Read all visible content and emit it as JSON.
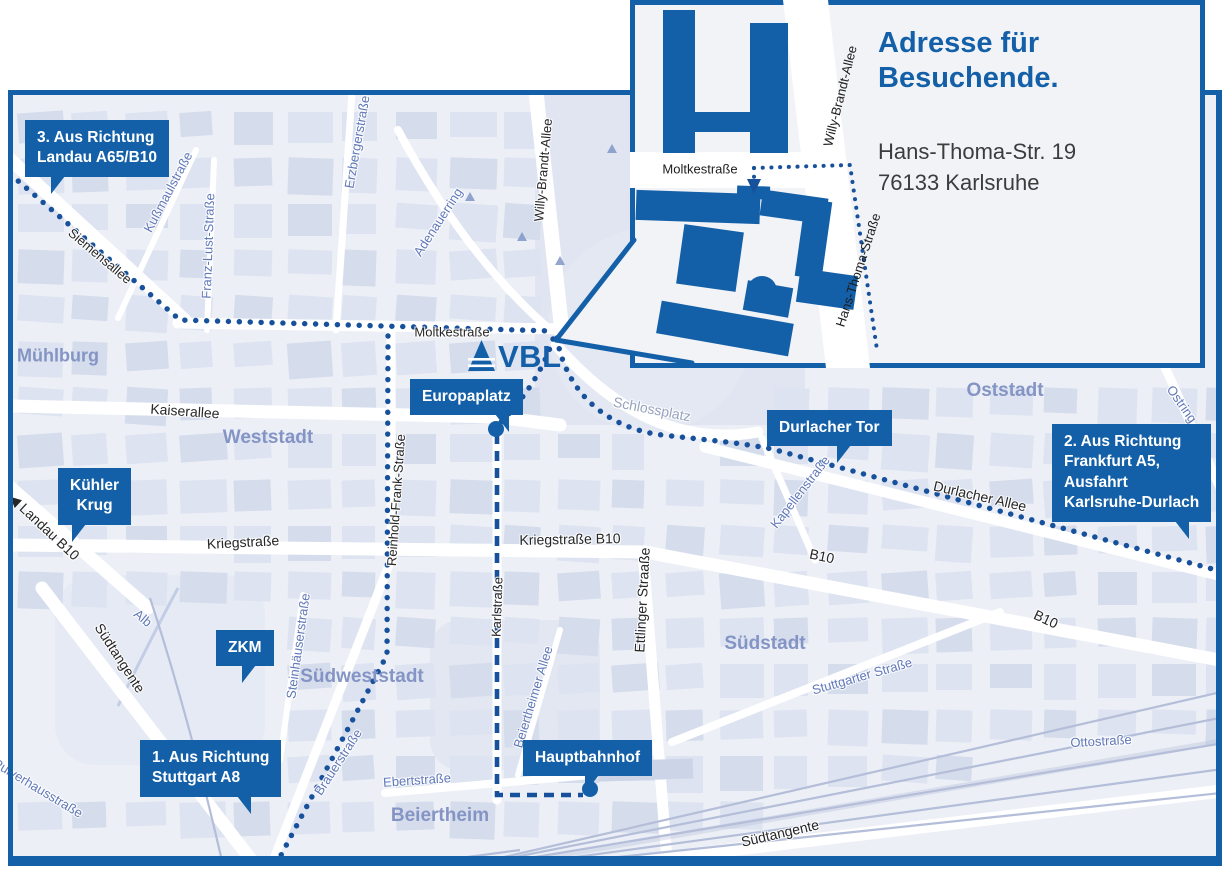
{
  "colors": {
    "brand_blue": "#1460a8",
    "route_blue": "#17519c",
    "map_bg": "#eceff6",
    "block": "#dde3f0",
    "block_dark": "#d5dcec",
    "road": "#ffffff",
    "railway": "#b4bed9",
    "district_label": "#8494c4",
    "street_blue": "#6078b8",
    "street_gray": "#97a2bd",
    "street_black": "#262626",
    "inset_bg": "#f2f3f7",
    "text_dark": "#3c3c3c"
  },
  "logo": {
    "text": "VBL"
  },
  "inset": {
    "title": [
      "Adresse für",
      "Besuchende."
    ],
    "address": [
      "Hans-Thoma-Str. 19",
      "76133 Karlsruhe"
    ],
    "street_labels": [
      {
        "t": "Moltkestraße",
        "x": 70,
        "y": 169,
        "r": 0
      },
      {
        "t": "Willy-Brandt-Allee",
        "x": 210,
        "y": 96,
        "r": -76
      },
      {
        "t": "Hans-Thoma-Straße",
        "x": 228,
        "y": 270,
        "r": -72
      }
    ]
  },
  "map": {
    "callouts": [
      {
        "id": "route-3",
        "lines": [
          "3. Aus Richtung",
          "Landau A65/B10"
        ],
        "x": 25,
        "y": 120,
        "tail": {
          "dir": "dl",
          "side": "left",
          "off": 26
        }
      },
      {
        "id": "kuehler-krug",
        "lines": [
          "Kühler",
          "Krug"
        ],
        "x": 58,
        "y": 468,
        "center": true,
        "tail": {
          "dir": "dl",
          "side": "left",
          "off": 14
        }
      },
      {
        "id": "zkm",
        "lines": [
          "ZKM"
        ],
        "x": 216,
        "y": 630,
        "center": true,
        "tail": {
          "dir": "dl",
          "side": "left",
          "off": 26
        }
      },
      {
        "id": "europaplatz",
        "lines": [
          "Europaplatz"
        ],
        "x": 410,
        "y": 379,
        "tail": {
          "dir": "dr",
          "side": "right",
          "off": 14
        }
      },
      {
        "id": "durlacher-tor",
        "lines": [
          "Durlacher Tor"
        ],
        "x": 767,
        "y": 410,
        "tail": {
          "dir": "dl",
          "side": "left",
          "off": 70
        }
      },
      {
        "id": "route-2",
        "lines": [
          "2. Aus Richtung",
          "Frankfurt A5,",
          "Ausfahrt",
          "Karlsruhe-Durlach"
        ],
        "x": 1052,
        "y": 424,
        "tail": {
          "dir": "dr",
          "side": "right",
          "off": 22
        }
      },
      {
        "id": "route-1",
        "lines": [
          "1. Aus Richtung",
          "Stuttgart A8"
        ],
        "x": 140,
        "y": 740,
        "tail": {
          "dir": "dr",
          "side": "right",
          "off": 30
        }
      },
      {
        "id": "hauptbahnhof",
        "lines": [
          "Hauptbahnhof"
        ],
        "x": 523,
        "y": 740,
        "tail": {
          "dir": "dl",
          "side": "left",
          "off": 62
        }
      }
    ],
    "markers": [
      {
        "name": "europaplatz-dot",
        "x": 496,
        "y": 429
      },
      {
        "name": "hauptbahnhof-dot",
        "x": 590,
        "y": 789
      }
    ],
    "street_labels": [
      {
        "t": "Siemensallee",
        "x": 100,
        "y": 256,
        "r": 40,
        "c": "black"
      },
      {
        "t": "Kußmaulstraße",
        "x": 168,
        "y": 192,
        "r": -62,
        "c": "blue"
      },
      {
        "t": "Franz-Lust-Straße",
        "x": 208,
        "y": 246,
        "r": -88,
        "c": "blue"
      },
      {
        "t": "Erzbergerstraße",
        "x": 357,
        "y": 142,
        "r": -80,
        "c": "blue"
      },
      {
        "t": "Adenauerring",
        "x": 438,
        "y": 222,
        "r": -57,
        "c": "blue"
      },
      {
        "t": "Willy-Brandt-Allee",
        "x": 543,
        "y": 170,
        "r": -85,
        "c": "black"
      },
      {
        "t": "Moltkestraße",
        "x": 452,
        "y": 332,
        "r": 0,
        "c": "black"
      },
      {
        "t": "Kaiserallee",
        "x": 185,
        "y": 411,
        "r": 4,
        "c": "black",
        "s": 14
      },
      {
        "t": "Kriegstraße",
        "x": 243,
        "y": 542,
        "r": -3,
        "c": "black",
        "s": 14
      },
      {
        "t": "Kriegstraße B10",
        "x": 570,
        "y": 539,
        "r": -1,
        "c": "black",
        "s": 14
      },
      {
        "t": "Reinhold-Frank-Straße",
        "x": 396,
        "y": 500,
        "r": -86,
        "c": "black"
      },
      {
        "t": "Karlstraße",
        "x": 497,
        "y": 607,
        "r": -88,
        "c": "black"
      },
      {
        "t": "Ettlinger Straaße",
        "x": 642,
        "y": 600,
        "r": -87,
        "c": "black",
        "s": 14
      },
      {
        "t": "Schlossplatz",
        "x": 652,
        "y": 409,
        "r": 11,
        "c": "gray",
        "s": 14
      },
      {
        "t": "Durlacher Allee",
        "x": 980,
        "y": 496,
        "r": 13,
        "c": "black",
        "s": 14
      },
      {
        "t": "Kapellenstraße",
        "x": 800,
        "y": 492,
        "r": -52,
        "c": "blue"
      },
      {
        "t": "B10",
        "x": 822,
        "y": 556,
        "r": 12,
        "c": "black",
        "s": 14
      },
      {
        "t": "B10",
        "x": 1046,
        "y": 619,
        "r": 25,
        "c": "black",
        "s": 14
      },
      {
        "t": "◀ Landau B10",
        "x": 44,
        "y": 527,
        "r": 43,
        "c": "black",
        "s": 14
      },
      {
        "t": "Südtangente",
        "x": 120,
        "y": 658,
        "r": 57,
        "c": "black",
        "s": 14
      },
      {
        "t": "Südtangente",
        "x": 780,
        "y": 833,
        "r": -13,
        "c": "black",
        "s": 14
      },
      {
        "t": "Alb",
        "x": 143,
        "y": 618,
        "r": 40,
        "c": "blue"
      },
      {
        "t": "Steinhäuserstraße",
        "x": 298,
        "y": 646,
        "r": -82,
        "c": "blue"
      },
      {
        "t": "Brauerstraße",
        "x": 338,
        "y": 762,
        "r": -57,
        "c": "blue"
      },
      {
        "t": "Ebertstraße",
        "x": 417,
        "y": 780,
        "r": -4,
        "c": "blue"
      },
      {
        "t": "Beiertheimer Allee",
        "x": 533,
        "y": 697,
        "r": -73,
        "c": "blue"
      },
      {
        "t": "Stuttgarter Straße",
        "x": 862,
        "y": 676,
        "r": -16,
        "c": "blue"
      },
      {
        "t": "Ottostraße",
        "x": 1101,
        "y": 741,
        "r": -3,
        "c": "blue"
      },
      {
        "t": "Pulverhausstraße",
        "x": 38,
        "y": 788,
        "r": 31,
        "c": "blue"
      },
      {
        "t": "Ostring",
        "x": 1182,
        "y": 404,
        "r": 55,
        "c": "blue"
      }
    ],
    "district_labels": [
      {
        "t": "Mühlburg",
        "x": 58,
        "y": 356,
        "s": 18
      },
      {
        "t": "Weststadt",
        "x": 268,
        "y": 438
      },
      {
        "t": "Oststadt",
        "x": 1005,
        "y": 391
      },
      {
        "t": "Südweststadt",
        "x": 362,
        "y": 677
      },
      {
        "t": "Südstadt",
        "x": 765,
        "y": 644
      },
      {
        "t": "Beiertheim",
        "x": 440,
        "y": 816
      }
    ]
  }
}
